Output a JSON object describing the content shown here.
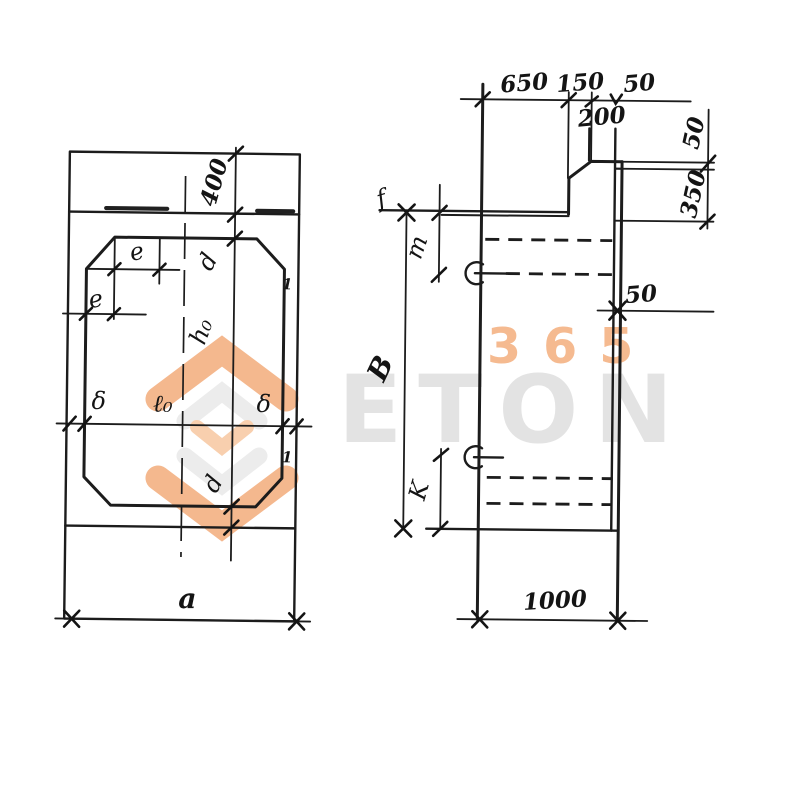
{
  "colors": {
    "ink": "#1c1c1c",
    "paper": "#ffffff",
    "watermark_orange": "#f4b88e",
    "watermark_orange_light": "#f8cfae",
    "watermark_gray": "#e3e3e3"
  },
  "watermark": {
    "word": "ETON",
    "digits": "365"
  },
  "left_view": {
    "dim_400": "400",
    "dim_d_top": "d",
    "dim_e_top": "e",
    "dim_e_left": "e",
    "dim_h0": "h₀",
    "dim_l0": "ℓ₀",
    "dim_delta_left": "δ",
    "dim_delta_right": "δ",
    "dim_d_bottom": "d",
    "dim_a": "a",
    "mark_1_upper": "1",
    "mark_1_lower": "1"
  },
  "right_view": {
    "dim_650": "650",
    "dim_150": "150",
    "dim_50_top": "50",
    "dim_200": "200",
    "dim_50_right_top": "50",
    "dim_350": "350",
    "dim_50_mid": "50",
    "dim_f": "f",
    "dim_m": "m",
    "dim_B": "B",
    "dim_K": "K",
    "dim_1000": "1000"
  }
}
